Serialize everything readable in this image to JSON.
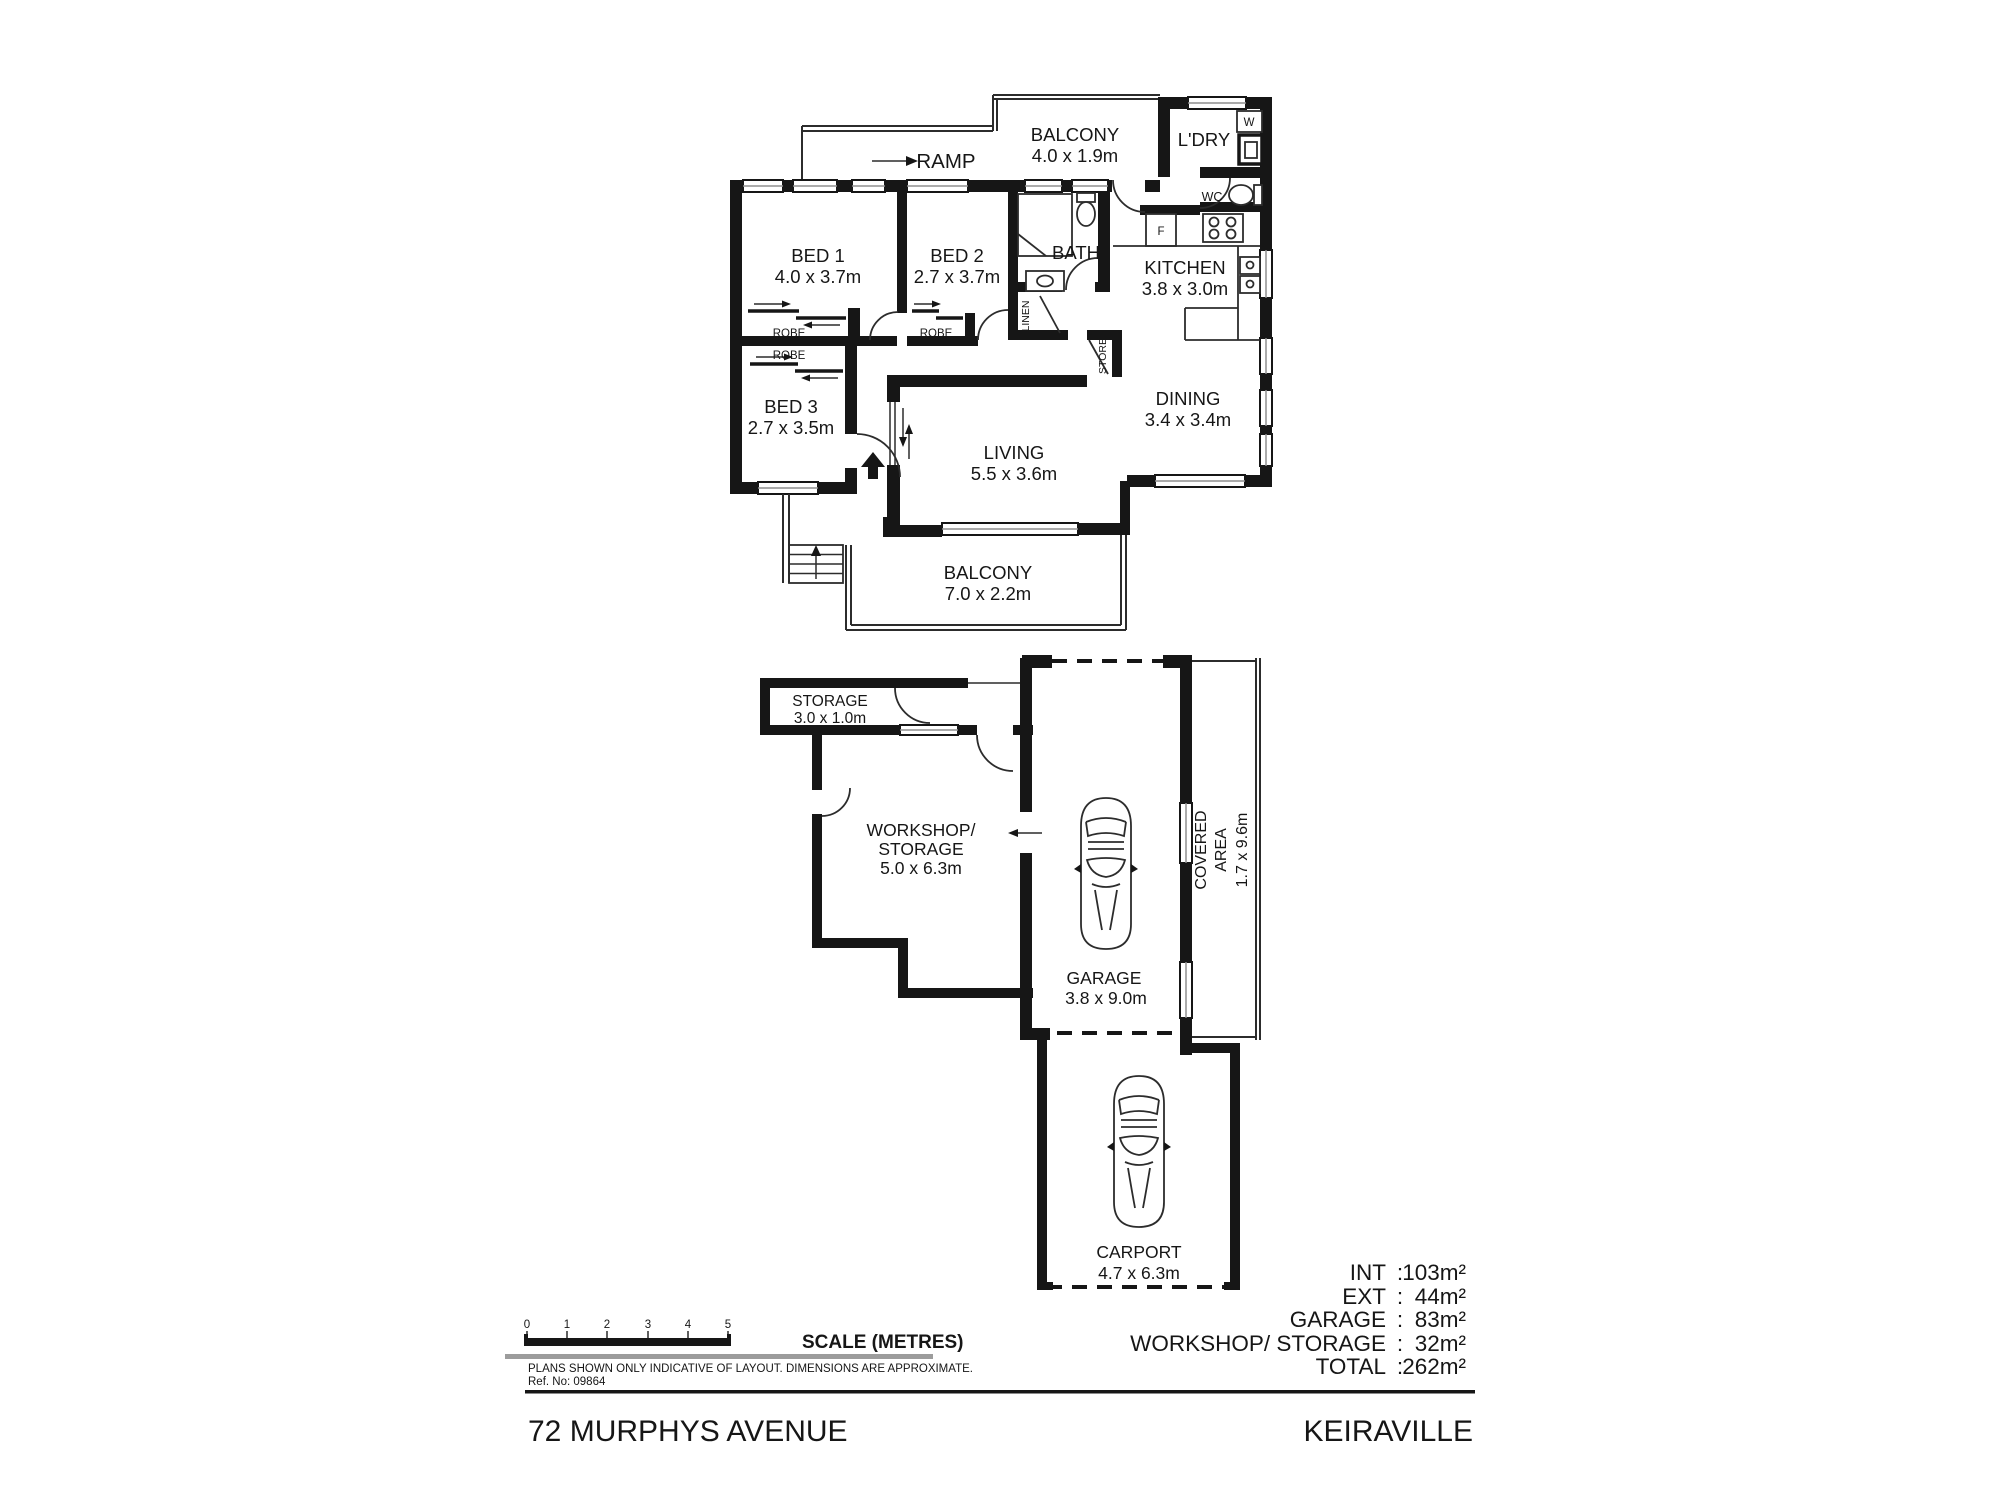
{
  "plan_upper": {
    "ramp": "RAMP",
    "balcony_top": {
      "name": "BALCONY",
      "dims": "4.0 x 1.9m"
    },
    "laundry": {
      "name": "L'DRY",
      "washer": "W"
    },
    "wc": "WC",
    "bed1": {
      "name": "BED 1",
      "dims": "4.0 x 3.7m"
    },
    "bed2": {
      "name": "BED 2",
      "dims": "2.7 x 3.7m"
    },
    "bed3": {
      "name": "BED 3",
      "dims": "2.7 x 3.5m"
    },
    "bath": "BATH",
    "kitchen": {
      "name": "KITCHEN",
      "dims": "3.8 x 3.0m",
      "fridge": "F"
    },
    "dining": {
      "name": "DINING",
      "dims": "3.4 x 3.4m"
    },
    "living": {
      "name": "LIVING",
      "dims": "5.5 x 3.6m"
    },
    "robe": "ROBE",
    "linen": "LINEN",
    "store": "STORE",
    "balcony_bottom": {
      "name": "BALCONY",
      "dims": "7.0 x 2.2m"
    }
  },
  "plan_lower": {
    "storage": {
      "name": "STORAGE",
      "dims": "3.0 x 1.0m"
    },
    "workshop": {
      "line1": "WORKSHOP/",
      "line2": "STORAGE",
      "dims": "5.0 x 6.3m"
    },
    "garage": {
      "name": "GARAGE",
      "dims": "3.8 x 9.0m"
    },
    "covered": {
      "line1": "COVERED",
      "line2": "AREA",
      "dims": "1.7 x 9.6m"
    },
    "carport": {
      "name": "CARPORT",
      "dims": "4.7 x 6.3m"
    }
  },
  "scale_bar": {
    "title": "SCALE (METRES)",
    "ticks": [
      "0",
      "1",
      "2",
      "3",
      "4",
      "5"
    ]
  },
  "notes": {
    "disclaimer": "PLANS SHOWN ONLY INDICATIVE OF LAYOUT.  DIMENSIONS ARE APPROXIMATE.",
    "ref": "Ref. No: 09864"
  },
  "title_block": {
    "address": "72 MURPHYS AVENUE",
    "suburb": "KEIRAVILLE"
  },
  "areas": {
    "sep": ":",
    "rows": [
      {
        "label": "INT",
        "value": "103m²"
      },
      {
        "label": "EXT",
        "value": "44m²"
      },
      {
        "label": "GARAGE",
        "value": "83m²"
      },
      {
        "label": "WORKSHOP/ STORAGE",
        "value": "32m²"
      },
      {
        "label": "TOTAL",
        "value": "262m²"
      }
    ]
  }
}
